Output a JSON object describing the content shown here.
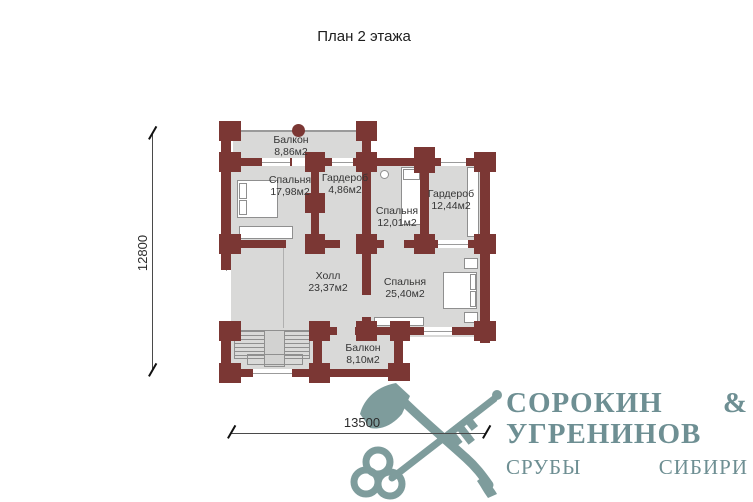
{
  "title": "План 2 этажа",
  "plan": {
    "rooms": [
      {
        "name": "Балкон",
        "area": "8,86м2"
      },
      {
        "name": "Спальня",
        "area": "17,98м2"
      },
      {
        "name": "Гардероб",
        "area": "4,86м2"
      },
      {
        "name": "Спальня",
        "area": "12,01м2"
      },
      {
        "name": "Гардероб",
        "area": "12,44м2"
      },
      {
        "name": "Холл",
        "area": "23,37м2"
      },
      {
        "name": "Спальня",
        "area": "25,40м2"
      },
      {
        "name": "Балкон",
        "area": "8,10м2"
      }
    ],
    "colors": {
      "wall": "#7b3734",
      "room_fill": "#d9d9d8",
      "logo": "#6e8f93",
      "logo_icon": "#7e9c9c"
    }
  },
  "dimensions": {
    "vertical": "12800",
    "horizontal": "13500"
  },
  "logo": {
    "line1": "СОРОКИН &",
    "line2": "УГРЕНИНОВ",
    "line3": "СРУБЫ СИБИРИ"
  }
}
